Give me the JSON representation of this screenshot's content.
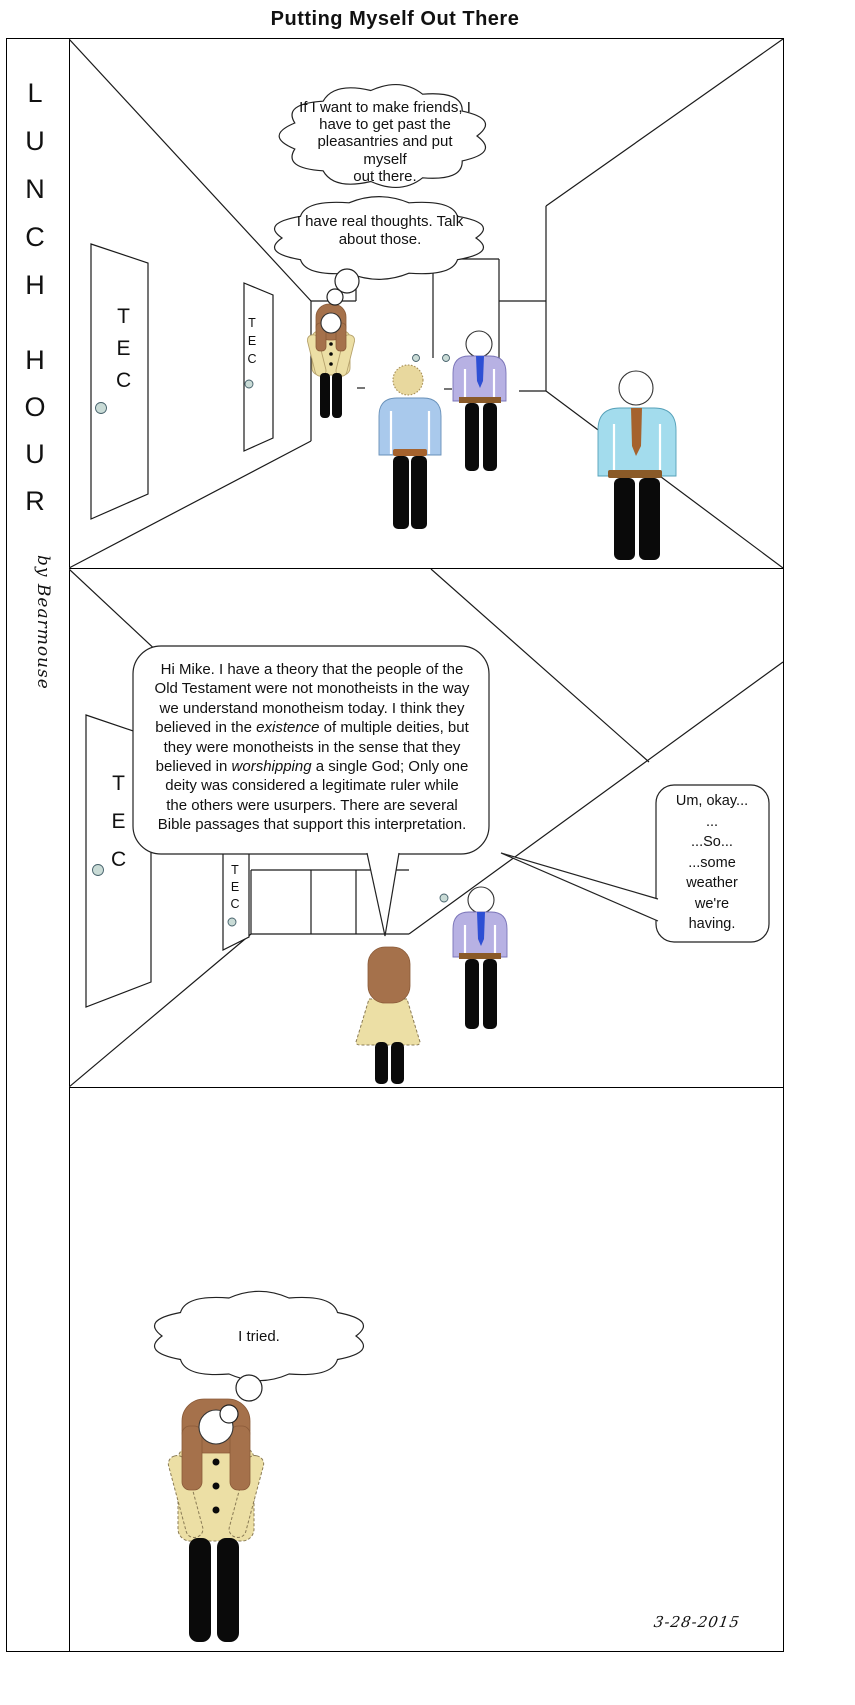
{
  "title": "Putting Myself Out There",
  "sidebar": {
    "series_top": "LUNCH",
    "series_bottom": "HOUR",
    "byline": "by Bearmouse"
  },
  "door_label": "TEC",
  "panel1": {
    "thought1": "If I want to make friends, I\nhave to get past the\npleasantries and put myself\nout there.",
    "thought2": "I have real thoughts.   Talk\nabout those."
  },
  "panel2": {
    "speech_lines": [
      "Hi Mike.  I have a theory that the people of the",
      "Old Testament were not monotheists in the way",
      "we understand monotheism today.  I think they",
      "believed in the *existence* of multiple deities, but",
      "they were monotheists in the sense that they",
      "believed in *worshipping* a single God; Only one",
      "deity was considered a legitimate ruler while",
      "the others were usurpers.   There are several",
      "Bible passages that support this interpretation."
    ],
    "reply": "Um, okay...\n...\n...So...\n...some\nweather\nwe're\nhaving."
  },
  "panel3": {
    "thought": "I tried.",
    "date": "3-28-2015"
  },
  "colors": {
    "hair": "#a5714b",
    "coat": "#ecdfa5",
    "shirt_blue": "#a9c9ec",
    "shirt_lavender": "#b7b1e3",
    "shirt_cyan": "#a3dced",
    "tie_blue": "#2e4fd4",
    "tie_brown": "#a5622d",
    "belt": "#8a5a28",
    "knob": "#c9dbd6",
    "hair_blond": "#e8d89e"
  }
}
